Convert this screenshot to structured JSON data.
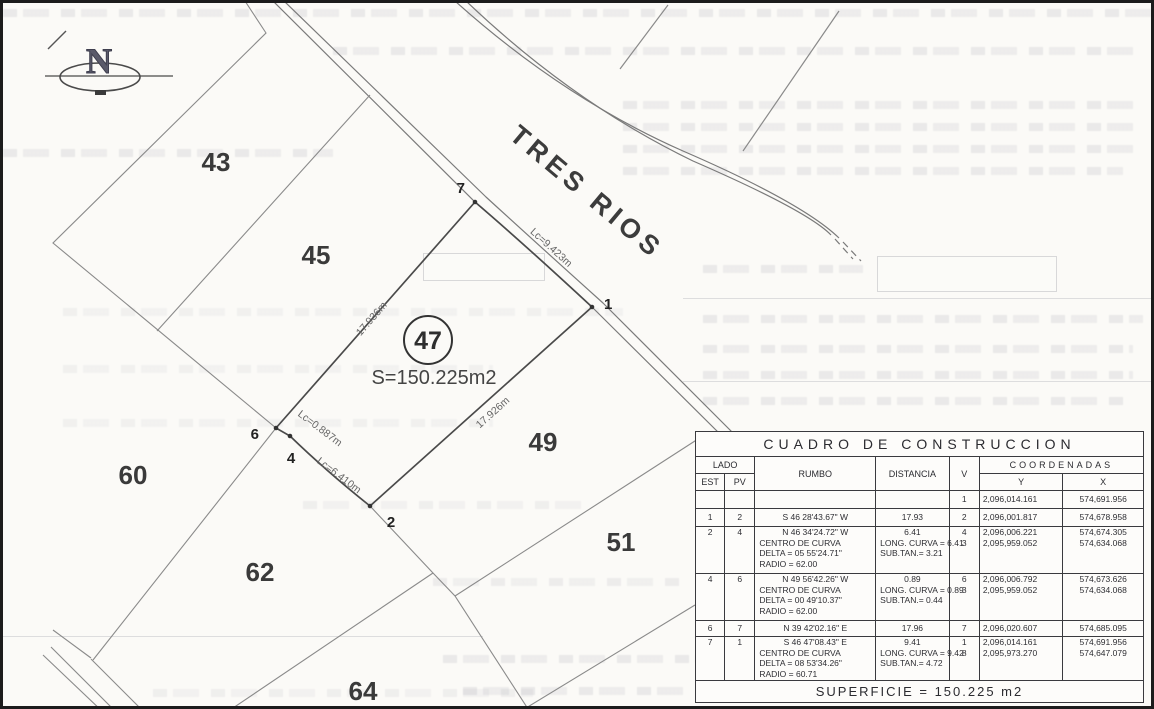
{
  "plan": {
    "north_label": "N",
    "street_name": "TRES RIOS",
    "subject_lot": {
      "number": "47",
      "area": "S=150.225m2"
    },
    "lots": [
      "43",
      "45",
      "49",
      "51",
      "60",
      "62",
      "64"
    ],
    "vertices": [
      "7",
      "1",
      "2",
      "4",
      "6"
    ],
    "dims": [
      "17.936m",
      "17.926m",
      "Lc=9.423m",
      "Lc=0.887m",
      "Lc=6.410m"
    ]
  },
  "table": {
    "title": "CUADRO DE CONSTRUCCION",
    "headers": {
      "lado": "LADO",
      "est": "EST",
      "pv": "PV",
      "rumbo": "RUMBO",
      "distancia": "DISTANCIA",
      "v": "V",
      "coordenadas": "COORDENADAS",
      "y": "Y",
      "x": "X"
    },
    "rows": [
      {
        "est": "",
        "pv": "",
        "rumbo": [],
        "dist": [],
        "v": [
          "1"
        ],
        "ycoord": [
          "2,096,014.161"
        ],
        "xcoord": [
          "574,691.956"
        ]
      },
      {
        "est": "1",
        "pv": "2",
        "rumbo": [
          "S 46 28'43.67\" W"
        ],
        "dist": [
          "17.93"
        ],
        "v": [
          "2"
        ],
        "ycoord": [
          "2,096,001.817"
        ],
        "xcoord": [
          "574,678.958"
        ]
      },
      {
        "est": "2",
        "pv": "4",
        "rumbo": [
          "N 46 34'24.72\" W",
          "CENTRO DE CURVA",
          "DELTA = 05 55'24.71\"",
          "RADIO = 62.00"
        ],
        "dist": [
          "6.41",
          "LONG. CURVA = 6.41",
          "SUB.TAN.= 3.21"
        ],
        "v": [
          "4",
          "3"
        ],
        "ycoord": [
          "2,096,006.221",
          "2,095,959.052"
        ],
        "xcoord": [
          "574,674.305",
          "574,634.068"
        ]
      },
      {
        "est": "4",
        "pv": "6",
        "rumbo": [
          "N 49 56'42.26\" W",
          "CENTRO DE CURVA",
          "DELTA = 00 49'10.37\"",
          "RADIO = 62.00"
        ],
        "dist": [
          "0.89",
          "LONG. CURVA = 0.89",
          "SUB.TAN.= 0.44"
        ],
        "v": [
          "6",
          "3"
        ],
        "ycoord": [
          "2,096,006.792",
          "2,095,959.052"
        ],
        "xcoord": [
          "574,673.626",
          "574,634.068"
        ]
      },
      {
        "est": "6",
        "pv": "7",
        "rumbo": [
          "N 39 42'02.16\" E"
        ],
        "dist": [
          "17.96"
        ],
        "v": [
          "7"
        ],
        "ycoord": [
          "2,096,020.607"
        ],
        "xcoord": [
          "574,685.095"
        ]
      },
      {
        "est": "7",
        "pv": "1",
        "rumbo": [
          "S 46 47'08.43\" E",
          "CENTRO DE CURVA",
          "DELTA = 08 53'34.26\"",
          "RADIO = 60.71"
        ],
        "dist": [
          "9.41",
          "LONG. CURVA = 9.42",
          "SUB.TAN.= 4.72"
        ],
        "v": [
          "1",
          "8"
        ],
        "ycoord": [
          "2,096,014.161",
          "2,095,973.270"
        ],
        "xcoord": [
          "574,691.956",
          "574,647.079"
        ]
      }
    ],
    "footer": "SUPERFICIE  =  150.225  m2"
  }
}
